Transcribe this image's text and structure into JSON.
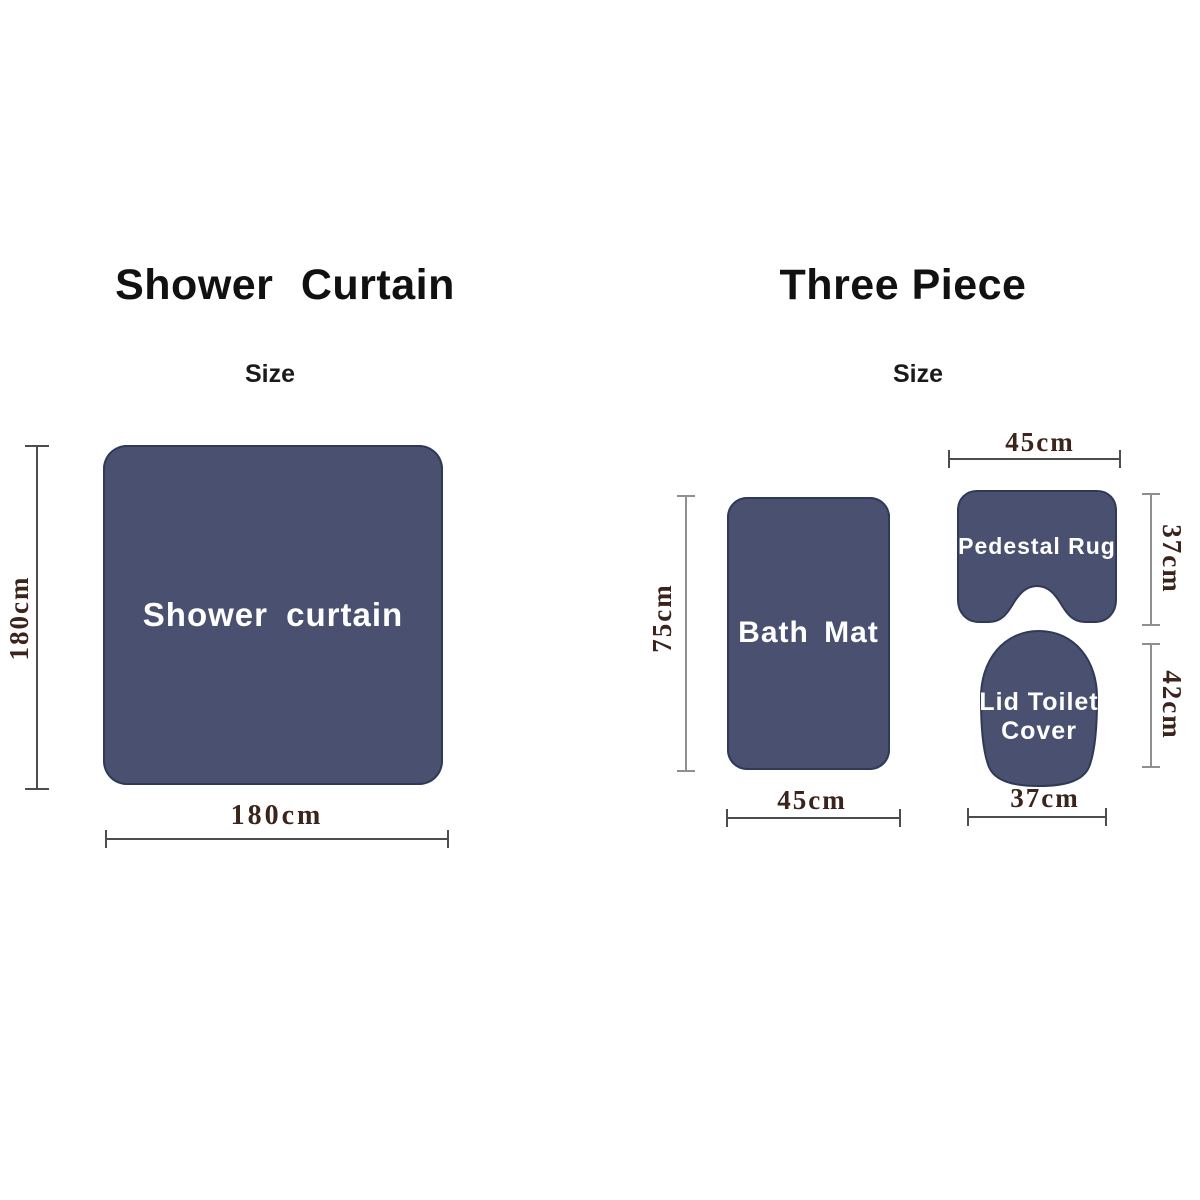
{
  "colors": {
    "shape_fill": "#4a5170",
    "shape_edge": "#303a58",
    "label_text": "#ffffff",
    "dimension_text": "#3a241c",
    "line_dark": "#4d4d4d",
    "line_gray": "#8f8f8f",
    "title_text": "#111111",
    "background": "#ffffff"
  },
  "shower_curtain": {
    "title": "Shower Curtain",
    "size_label": "Size",
    "shape_label": "Shower curtain",
    "height": "180cm",
    "width": "180cm"
  },
  "three_piece": {
    "title": "Three Piece",
    "size_label": "Size",
    "bath_mat": {
      "label": "Bath Mat",
      "height": "75cm",
      "width": "45cm"
    },
    "pedestal_rug": {
      "label": "Pedestal Rug",
      "width": "45cm",
      "height": "37cm"
    },
    "lid_toilet_cover": {
      "label_line1": "Lid Toilet",
      "label_line2": "Cover",
      "height": "42cm",
      "width": "37cm"
    }
  }
}
